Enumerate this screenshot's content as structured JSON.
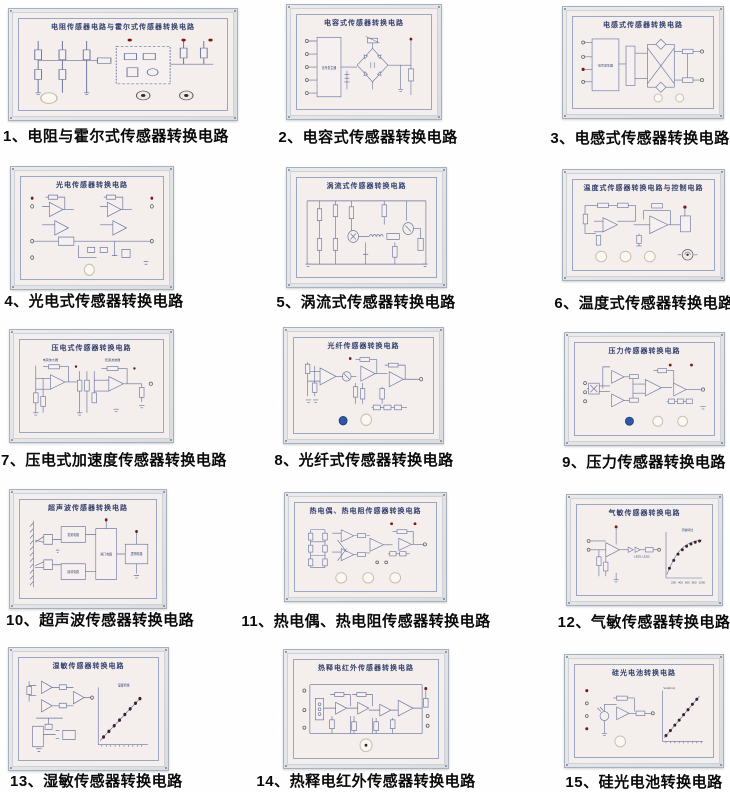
{
  "page": {
    "background": "#fefefe"
  },
  "colors": {
    "panel_frame": "#dfe3e7",
    "panel_face": "#f4eeed",
    "schematic_line": "#66739c",
    "caption_text": "#0a0a0a",
    "terminal_red": "#7e1616",
    "knob_blue": "#2e57a8",
    "graph_dot": "#3f1f2b"
  },
  "panels": [
    {
      "num": "1",
      "board_title": "电阻传感器电路与霍尔式传感器转换电路",
      "caption": "1、电阻与霍尔式传感器转换电路"
    },
    {
      "num": "2",
      "board_title": "电容式传感器转换电路",
      "caption": "2、电容式传感器转换电路",
      "labels": {
        "generator": "信号发生器"
      }
    },
    {
      "num": "3",
      "board_title": "电感式传感器转换电路",
      "caption": "3、电感式传感器转换电路",
      "labels": {
        "generator": "信号发生器"
      }
    },
    {
      "num": "4",
      "board_title": "光电传感器转换电路",
      "caption": "4、光电式传感器转换电路"
    },
    {
      "num": "5",
      "board_title": "涡流式传感器转换电路",
      "caption": "5、涡流式传感器转换电路"
    },
    {
      "num": "6",
      "board_title": "温度式传感器转换电路与控制电路",
      "caption": "6、温度式传感器转换电路"
    },
    {
      "num": "7",
      "board_title": "压电式传感器转换电路",
      "caption": "7、压电式加速度传感器转换电路",
      "labels": {
        "stage1": "电荷放大器",
        "stage2": "低通滤波器"
      }
    },
    {
      "num": "8",
      "board_title": "光纤传感器转换电路",
      "caption": "8、光纤式传感器转换电路"
    },
    {
      "num": "9",
      "board_title": "压力传感器转换电路",
      "caption": "9、压力传感器转换电路"
    },
    {
      "num": "10",
      "board_title": "超声波传感器转换电路",
      "caption": "10、超声波传感器转换电路",
      "labels": {
        "b1": "发射电路",
        "b2": "接收电路",
        "b3": "闸门电路",
        "b4": "逻辑电路"
      }
    },
    {
      "num": "11",
      "board_title": "热电偶、热电阻传感器转换电路",
      "caption": "11、热电偶、热电阻传感器转换电路"
    },
    {
      "num": "12",
      "board_title": "气敏传感器转换电路",
      "caption": "12、气敏传感器转换电路",
      "labels": {
        "graph_title": "灵敏特性"
      },
      "graph": {
        "ticks": [
          "200",
          "400",
          "600",
          "800",
          "1000"
        ]
      }
    },
    {
      "num": "13",
      "board_title": "湿敏传感器转换电路",
      "caption": "13、湿敏传感器转换电路",
      "labels": {
        "graph_title": "湿度特性"
      }
    },
    {
      "num": "14",
      "board_title": "热释电红外传感器转换电路",
      "caption": "14、热释电红外传感器转换电路"
    },
    {
      "num": "15",
      "board_title": "硅光电池转换电路",
      "caption": "15、硅光电池转换电路",
      "labels": {
        "y_axis": "Vout(mv)"
      }
    }
  ]
}
